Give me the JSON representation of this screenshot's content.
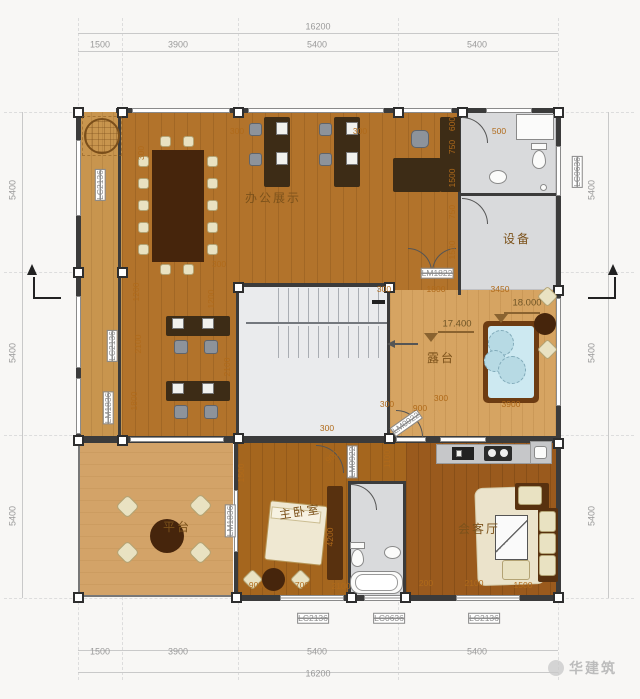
{
  "meta": {
    "type": "architectural-floor-plan",
    "floor_note": "top floor plan with office, terrace, bedroom, living room"
  },
  "colors": {
    "wood_office": "#b2732b",
    "wood_bedroom": "#a5661e",
    "wood_living": "#9a5a1d",
    "balcony_strip": "#c8954e",
    "terrace": "#d6a462",
    "platform": "#d3a368",
    "wet_room_gray": "#d9dadc",
    "stair_gray": "#eaebed",
    "wall": "#3b3b3b",
    "water": "#cde9f1",
    "dim_text": "#9a9a9a",
    "interior_dim_text": "#b06a1a",
    "room_label": "#7c521b"
  },
  "watermark": {
    "text": "华建筑"
  },
  "annotations": [
    {
      "text": "16200",
      "x": 318,
      "y": 27,
      "rot": 0,
      "kind": "dim"
    },
    {
      "text": "1500",
      "x": 100,
      "y": 45,
      "rot": 0,
      "kind": "dim"
    },
    {
      "text": "3900",
      "x": 178,
      "y": 45,
      "rot": 0,
      "kind": "dim"
    },
    {
      "text": "5400",
      "x": 317,
      "y": 45,
      "rot": 0,
      "kind": "dim"
    },
    {
      "text": "5400",
      "x": 477,
      "y": 45,
      "rot": 0,
      "kind": "dim"
    },
    {
      "text": "5400",
      "x": 13,
      "y": 190,
      "rot": -90,
      "kind": "dim"
    },
    {
      "text": "5400",
      "x": 13,
      "y": 353,
      "rot": -90,
      "kind": "dim"
    },
    {
      "text": "5400",
      "x": 13,
      "y": 516,
      "rot": -90,
      "kind": "dim"
    },
    {
      "text": "5400",
      "x": 592,
      "y": 190,
      "rot": -90,
      "kind": "dim"
    },
    {
      "text": "5400",
      "x": 592,
      "y": 353,
      "rot": -90,
      "kind": "dim"
    },
    {
      "text": "5400",
      "x": 592,
      "y": 516,
      "rot": -90,
      "kind": "dim"
    },
    {
      "text": "1500",
      "x": 100,
      "y": 652,
      "rot": 0,
      "kind": "dim"
    },
    {
      "text": "3900",
      "x": 178,
      "y": 652,
      "rot": 0,
      "kind": "dim"
    },
    {
      "text": "5400",
      "x": 317,
      "y": 652,
      "rot": 0,
      "kind": "dim"
    },
    {
      "text": "5400",
      "x": 477,
      "y": 652,
      "rot": 0,
      "kind": "dim"
    },
    {
      "text": "16200",
      "x": 318,
      "y": 674,
      "rot": 0,
      "kind": "dim"
    },
    {
      "text": "LC2136",
      "x": 313,
      "y": 618,
      "rot": 0,
      "kind": "win"
    },
    {
      "text": "LC0636",
      "x": 389,
      "y": 618,
      "rot": 0,
      "kind": "win"
    },
    {
      "text": "LC2136",
      "x": 484,
      "y": 618,
      "rot": 0,
      "kind": "win"
    },
    {
      "text": "LC2136",
      "x": 100,
      "y": 185,
      "rot": -90,
      "kind": "win"
    },
    {
      "text": "LC2136",
      "x": 112,
      "y": 346,
      "rot": -90,
      "kind": "win"
    },
    {
      "text": "LM1836",
      "x": 108,
      "y": 408,
      "rot": -90,
      "kind": "win"
    },
    {
      "text": "LM1836",
      "x": 230,
      "y": 521,
      "rot": -90,
      "kind": "win"
    },
    {
      "text": "LC0636",
      "x": 577,
      "y": 172,
      "rot": -90,
      "kind": "win"
    },
    {
      "text": "LM1822",
      "x": 437,
      "y": 273,
      "rot": 0,
      "kind": "win"
    },
    {
      "text": "LM0922",
      "x": 406,
      "y": 423,
      "rot": -35,
      "kind": "win"
    },
    {
      "text": "LM0922",
      "x": 352,
      "y": 462,
      "rot": -90,
      "kind": "win"
    },
    {
      "text": "办公展示",
      "x": 273,
      "y": 198,
      "rot": 0,
      "kind": "room"
    },
    {
      "text": "设备",
      "x": 517,
      "y": 239,
      "rot": 0,
      "kind": "room"
    },
    {
      "text": "露台",
      "x": 441,
      "y": 358,
      "rot": 0,
      "kind": "room"
    },
    {
      "text": "平台",
      "x": 177,
      "y": 527,
      "rot": 0,
      "kind": "room"
    },
    {
      "text": "主卧室",
      "x": 300,
      "y": 512,
      "rot": -8,
      "kind": "room"
    },
    {
      "text": "会客厅",
      "x": 479,
      "y": 529,
      "rot": 0,
      "kind": "room"
    },
    {
      "text": "17.400",
      "x": 457,
      "y": 324,
      "rot": 0,
      "kind": "elev"
    },
    {
      "text": "18.000",
      "x": 527,
      "y": 303,
      "rot": 0,
      "kind": "elev"
    },
    {
      "text": "300",
      "x": 237,
      "y": 131,
      "rot": 0,
      "kind": "idim"
    },
    {
      "text": "300",
      "x": 360,
      "y": 131,
      "rot": 0,
      "kind": "idim"
    },
    {
      "text": "500",
      "x": 499,
      "y": 131,
      "rot": 0,
      "kind": "idim"
    },
    {
      "text": "600",
      "x": 452,
      "y": 124,
      "rot": -90,
      "kind": "idim"
    },
    {
      "text": "750",
      "x": 452,
      "y": 147,
      "rot": -90,
      "kind": "idim"
    },
    {
      "text": "1500",
      "x": 452,
      "y": 178,
      "rot": -90,
      "kind": "idim"
    },
    {
      "text": "750",
      "x": 452,
      "y": 212,
      "rot": -90,
      "kind": "idim"
    },
    {
      "text": "1500",
      "x": 452,
      "y": 250,
      "rot": -90,
      "kind": "idim"
    },
    {
      "text": "300",
      "x": 141,
      "y": 153,
      "rot": -90,
      "kind": "idim"
    },
    {
      "text": "300",
      "x": 219,
      "y": 264,
      "rot": 0,
      "kind": "idim"
    },
    {
      "text": "1200",
      "x": 136,
      "y": 292,
      "rot": -90,
      "kind": "idim"
    },
    {
      "text": "2100",
      "x": 138,
      "y": 344,
      "rot": -90,
      "kind": "idim"
    },
    {
      "text": "1800",
      "x": 134,
      "y": 401,
      "rot": -90,
      "kind": "idim"
    },
    {
      "text": "1200",
      "x": 211,
      "y": 299,
      "rot": -90,
      "kind": "idim"
    },
    {
      "text": "2100",
      "x": 227,
      "y": 367,
      "rot": -90,
      "kind": "idim"
    },
    {
      "text": "300",
      "x": 384,
      "y": 289,
      "rot": 0,
      "kind": "idim"
    },
    {
      "text": "1800",
      "x": 436,
      "y": 289,
      "rot": 0,
      "kind": "idim"
    },
    {
      "text": "3450",
      "x": 500,
      "y": 289,
      "rot": 0,
      "kind": "idim"
    },
    {
      "text": "3900",
      "x": 511,
      "y": 404,
      "rot": 0,
      "kind": "idim"
    },
    {
      "text": "300",
      "x": 441,
      "y": 398,
      "rot": 0,
      "kind": "idim"
    },
    {
      "text": "900",
      "x": 420,
      "y": 408,
      "rot": 0,
      "kind": "idim"
    },
    {
      "text": "300",
      "x": 387,
      "y": 404,
      "rot": 0,
      "kind": "idim"
    },
    {
      "text": "300",
      "x": 327,
      "y": 428,
      "rot": 0,
      "kind": "idim"
    },
    {
      "text": "900",
      "x": 332,
      "y": 457,
      "rot": -40,
      "kind": "idim"
    },
    {
      "text": "1100",
      "x": 387,
      "y": 459,
      "rot": -90,
      "kind": "idim"
    },
    {
      "text": "1500",
      "x": 241,
      "y": 473,
      "rot": -90,
      "kind": "idim"
    },
    {
      "text": "4200",
      "x": 330,
      "y": 537,
      "rot": -90,
      "kind": "idim"
    },
    {
      "text": "900",
      "x": 256,
      "y": 585,
      "rot": 0,
      "kind": "idim"
    },
    {
      "text": "700",
      "x": 302,
      "y": 585,
      "rot": 0,
      "kind": "idim"
    },
    {
      "text": "2100",
      "x": 341,
      "y": 586,
      "rot": 0,
      "kind": "idim"
    },
    {
      "text": "200",
      "x": 426,
      "y": 583,
      "rot": 0,
      "kind": "idim"
    },
    {
      "text": "2100",
      "x": 474,
      "y": 583,
      "rot": 0,
      "kind": "idim"
    },
    {
      "text": "1500",
      "x": 523,
      "y": 585,
      "rot": 0,
      "kind": "idim"
    }
  ]
}
